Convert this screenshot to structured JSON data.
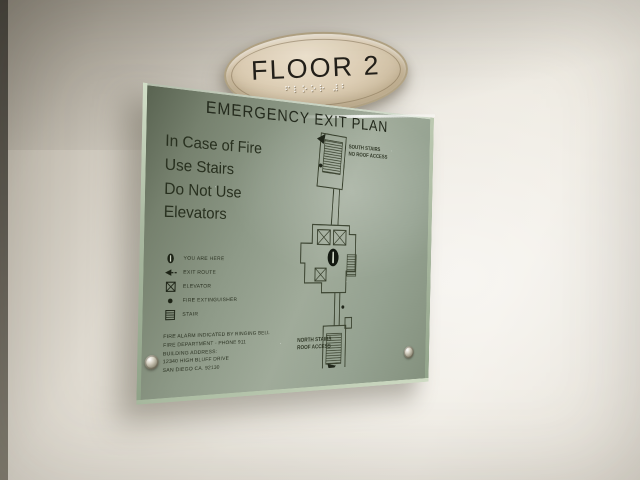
{
  "floor_sign": {
    "label": "FLOOR 2",
    "braille": "⠋⠇⠕⠕⠗ ⠼⠃"
  },
  "exit_plan": {
    "title": "EMERGENCY EXIT PLAN",
    "instructions": [
      "In Case of Fire",
      "Use Stairs",
      "Do Not Use",
      "Elevators"
    ],
    "legend": [
      {
        "icon": "you-are-here-icon",
        "label": "YOU ARE HERE"
      },
      {
        "icon": "exit-route-arrow-icon",
        "label": "EXIT ROUTE"
      },
      {
        "icon": "elevator-icon",
        "label": "ELEVATOR"
      },
      {
        "icon": "fire-extinguisher-icon",
        "label": "FIRE EXTINGUISHER"
      },
      {
        "icon": "stair-icon",
        "label": "STAIR"
      }
    ],
    "fine_print": [
      "FIRE ALARM INDICATED BY RINGING BELL",
      "FIRE DEPARTMENT - PHONE 911",
      "BUILDING ADDRESS:",
      "12340 HIGH BLUFF DRIVE",
      "SAN DIEGO CA. 92130"
    ],
    "map": {
      "south_stairs_label": [
        "SOUTH STAIRS",
        "NO ROOF ACCESS"
      ],
      "north_stairs_label": [
        "NORTH STAIRS",
        "ROOF ACCESS"
      ]
    }
  },
  "colors": {
    "wall": "#e9e5dc",
    "glass": "#93a08e",
    "oval": "#d9cdb5",
    "ink": "#2a3122",
    "map_line": "#39412e"
  }
}
